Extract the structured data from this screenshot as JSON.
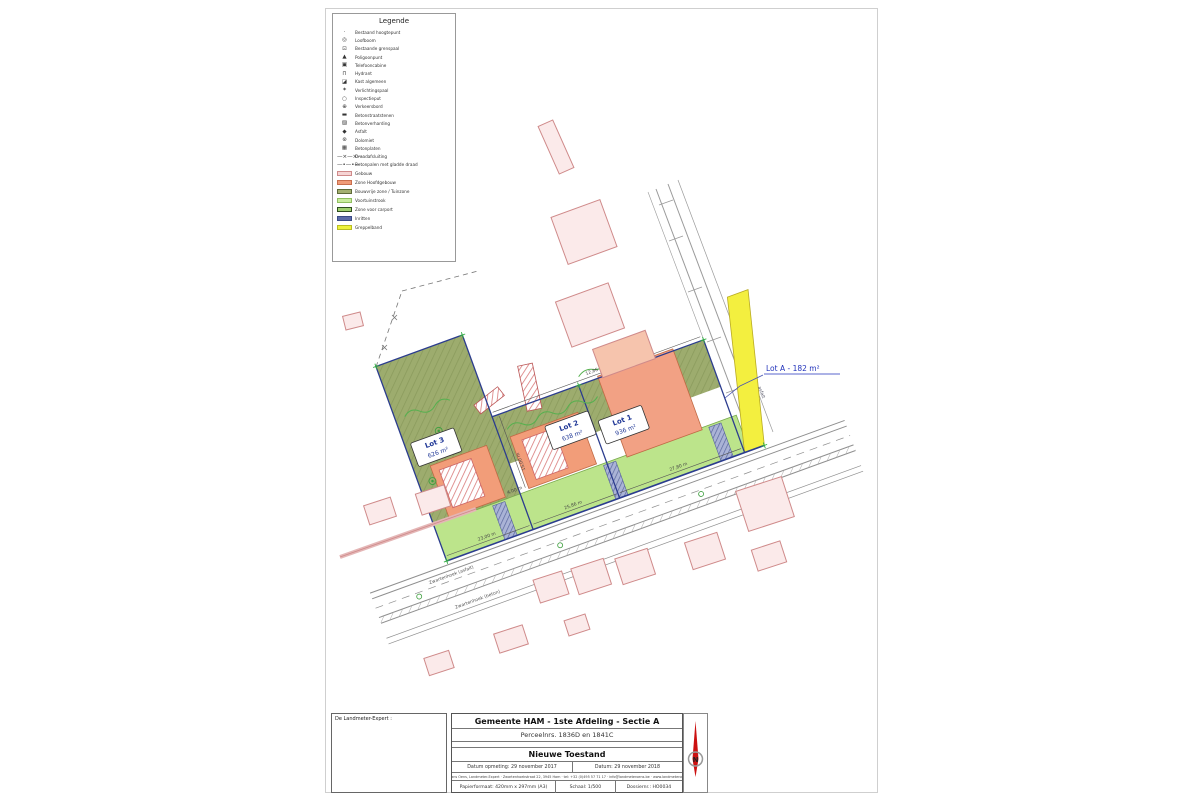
{
  "legend": {
    "title": "Legende",
    "symbol_items": [
      {
        "icon": "elevation-point-icon",
        "glyph": "·",
        "label": "Bestaand hoogtepunt"
      },
      {
        "icon": "tree-icon",
        "glyph": "◎",
        "label": "Loofboom"
      },
      {
        "icon": "boundary-post-icon",
        "glyph": "⊡",
        "label": "Bestaande grenspaal"
      },
      {
        "icon": "polygon-point-icon",
        "glyph": "▲",
        "label": "Poligoonpunt"
      },
      {
        "icon": "telecom-cabinet-icon",
        "glyph": "▣",
        "label": "Telefooncabine"
      },
      {
        "icon": "hydrant-icon",
        "glyph": "⊓",
        "label": "Hydrant"
      },
      {
        "icon": "utility-cabinet-icon",
        "glyph": "◪",
        "label": "Kast algemeen"
      },
      {
        "icon": "light-pole-icon",
        "glyph": "✶",
        "label": "Verlichtingspaal"
      },
      {
        "icon": "manhole-icon",
        "glyph": "○",
        "label": "Inspectieput"
      },
      {
        "icon": "traffic-sign-icon",
        "glyph": "⊕",
        "label": "Verkeersbord"
      },
      {
        "icon": "paving-stones-icon",
        "glyph": "▬",
        "label": "Betonstraatstenen"
      },
      {
        "icon": "concrete-surface-icon",
        "glyph": "▨",
        "label": "Betonverharding"
      },
      {
        "icon": "asphalt-icon",
        "glyph": "◆",
        "label": "Asfalt"
      },
      {
        "icon": "dolomite-icon",
        "glyph": "⊛",
        "label": "Dolomiet"
      },
      {
        "icon": "concrete-slabs-icon",
        "glyph": "▦",
        "label": "Betonplaten"
      },
      {
        "icon": "wire-fence-line-icon",
        "glyph": "—×—×—",
        "label": "Draadafsluiting"
      },
      {
        "icon": "post-wire-line-icon",
        "glyph": "—•—•—",
        "label": "Betonpalen met gladde draad"
      }
    ],
    "swatch_items": [
      {
        "icon": "building-swatch",
        "fill": "#f6d4d4",
        "border": "#cf8a8a",
        "label": "Gebouw"
      },
      {
        "icon": "main-building-zone-swatch",
        "fill": "#f09b78",
        "border": "#c96f4e",
        "label": "Zone Hoofdgebouw"
      },
      {
        "icon": "garden-zone-swatch",
        "fill": "#a3b070",
        "border": "#5f6b3a",
        "label": "Bouwvrije zone / Tuinzone"
      },
      {
        "icon": "front-garden-swatch",
        "fill": "#c9ec9e",
        "border": "#8fbf5f",
        "label": "Voortuinstrook"
      },
      {
        "icon": "carport-zone-swatch",
        "fill": "#9ed06f",
        "border": "#2f4d1f",
        "label": "Zone voor carport"
      },
      {
        "icon": "driveway-swatch",
        "fill": "#5b6aa8",
        "border": "#3a4a86",
        "label": "Inritten"
      },
      {
        "icon": "gutter-band-swatch",
        "fill": "#eef23c",
        "border": "#b9bd23",
        "label": "Greppelband"
      }
    ]
  },
  "plan": {
    "lots": [
      {
        "label": "Lot 3",
        "area": "626 m²"
      },
      {
        "label": "Lot 2",
        "area": "638 m²"
      },
      {
        "label": "Lot 1",
        "area": "936 m²"
      }
    ],
    "lot_a_label": "Lot A - 182 m²",
    "street_labels": [
      "Zwartenhoek (asfalt)",
      "Zwartenhoek (beton)",
      "asfalt"
    ],
    "dimensions": [
      "23,00 m",
      "25,86 m",
      "27,80 m",
      "15,00 m",
      "4,00 m",
      "12,86 m"
    ],
    "colors": {
      "garden_zone": "#9dac6e",
      "front_strip": "#bce48b",
      "main_zone": "#f29d79",
      "lot_a_strip": "#f3ef3f",
      "building_outline": "#cf8a8a",
      "boundary_blue": "#2b3c8e",
      "label_blue": "#2233bb",
      "marker_green": "#2fae3e"
    }
  },
  "notes": {
    "revisions": [
      "Datum: 17 februari 2020 - Aanpassing volgens mailing omgevingsloket dd. 17 februari 2020",
      "Datum: 16 december 2019 - Aanpassing volgens mailing omgevingsloket dd. 16 december 2019"
    ],
    "surveyor_heading": "De Landmeter-Expert :",
    "surveyor_lines": [
      "Ing. Hans Oens,",
      "Zwartenhoekstraat 22, 3945 Ham",
      "Beëdigd voor de rechtbank van",
      "Eerste Aanleg te Hasselt",
      "ID. nr. tableau : LAN 061270"
    ]
  },
  "titleblock": {
    "municipality": "Gemeente HAM - 1ste Afdeling  - Sectie A",
    "parcels": "Perceelnrs. 1836D en 1841C",
    "state": "Nieuwe Toestand",
    "date_survey": "Datum opmeting: 29 november 2017",
    "date": "Datum: 29 november 2018",
    "contact": "Ing. Hans Oens, Landmeter-Expert · Zwartenhoekstraat 22, 3945 Ham · tel: +32 (0)495 57 71 17 · info@landmeteroens.be · www.landmeteroens.be",
    "paper": "Papierformaat: 420mm x 297mm (A3)",
    "scale": "Schaal: 1/500",
    "dossier": "Dossiernr.: HO0034",
    "north_label": "N"
  }
}
